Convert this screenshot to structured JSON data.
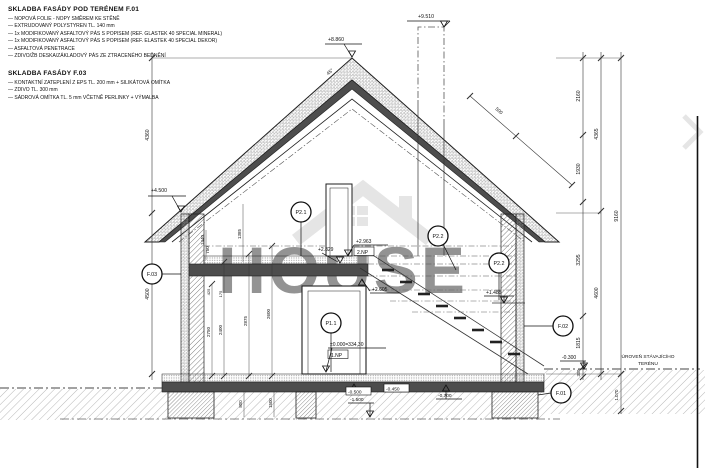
{
  "blocks": {
    "f01": {
      "title": "SKLADBA FASÁDY POD TERÉNEM F.01",
      "lines": [
        "— NOPOVÁ FOLIE - NOPY SMĚREM KE STĚNĚ",
        "— EXTRUDOVANÝ POLYSTYREN TL. 140 mm",
        "— 1x MODIFIKOVANÝ ASFALTOVÝ PÁS S POPISEM (REF. GLASTEK 40 SPECIAL MINERAL)",
        "— 1x MODIFIKOVANÝ ASFALTOVÝ PÁS S POPISEM (REF. ELASTEK 40 SPECIAL DEKOR)",
        "— ASFALTOVÁ PENETRACE",
        "— ZDIVO/ŽB DESKA/ZÁKLADOVÝ PÁS ZE ZTRACENÉHO BEDNĚNÍ"
      ]
    },
    "f03": {
      "title": "SKLADBA FASÁDY F.03",
      "lines": [
        "— KONTAKTNÍ ZATEPLENÍ Z EPS TL. 200 mm + SILIKÁTOVÁ OMÍTKA",
        "— ZDIVO TL. 300 mm",
        "— SÁDROVÁ OMÍTKA TL. 5 mm VČETNĚ PERLINKY + VÝMALBA"
      ]
    }
  },
  "levels": {
    "chimney_top": "+9.510",
    "ridge": "+8.860",
    "eave": "+4.500",
    "floor2": "+2.963",
    "floor2_tag": "2.NP",
    "ceiling1": "+2.829",
    "slab2_bottom": "+2.605",
    "landing": "+1.485",
    "floor1": "±0.000=334,30",
    "floor1_tag": "1.NP",
    "terrain": "-0.300",
    "foundation_step": "-0.500",
    "foundation_bottom": "-1.500",
    "slab_bottom": "-0.450",
    "footing": "-0.700"
  },
  "markers": {
    "f01": "F.01",
    "f02": "F.02",
    "f03": "F.03",
    "p11": "P1.1",
    "p21": "P2.1",
    "p22": "P2.2"
  },
  "dims": {
    "left": [
      "4360",
      "4500"
    ],
    "right_inner": [
      "2160",
      "1930",
      "3295",
      "1815",
      "300"
    ],
    "right_mid": [
      "4365",
      "4600"
    ],
    "right_outer": [
      "9160",
      "1.070"
    ],
    "interior": [
      "2750",
      "2400",
      "2875",
      "2600"
    ],
    "interior_top": [
      "425",
      "175"
    ],
    "attic": [
      "1440",
      "750",
      "1385"
    ],
    "roof": "500",
    "foundation": [
      "800",
      "1500"
    ],
    "roof_angle": "45°"
  },
  "annotations": {
    "terrain_line1": "ÚROVEŇ STÁVAJÍCÍHO",
    "terrain_line2": "TERÉNU"
  },
  "watermark": {
    "text": "HOUSE"
  },
  "colors": {
    "ink": "#1f1f1f",
    "concrete": "#4d4d4d",
    "watermark": "#c6c6c6",
    "ground_hatch": "#a8a8a8"
  }
}
